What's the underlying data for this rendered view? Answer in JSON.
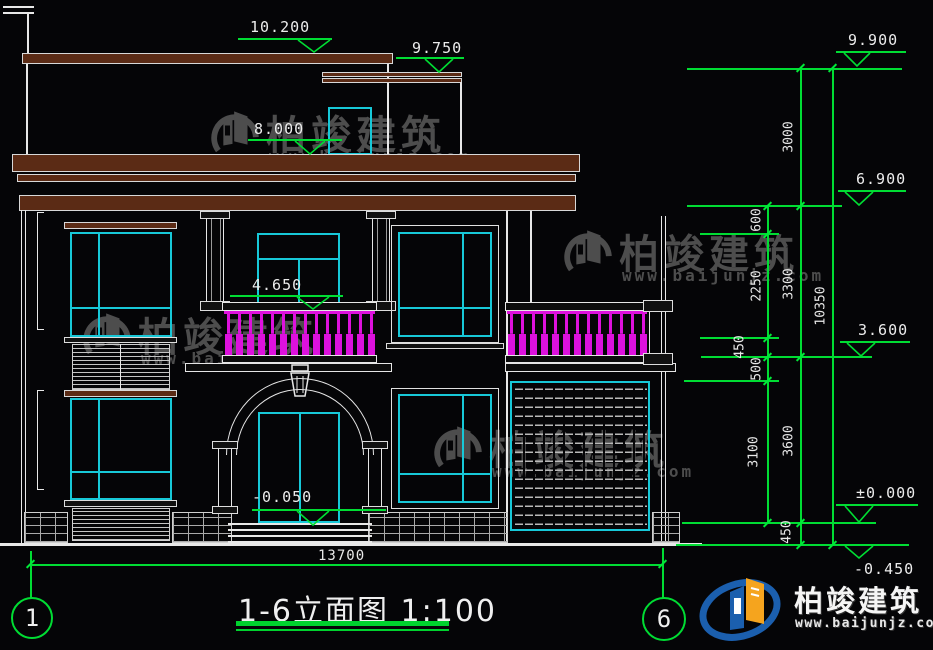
{
  "drawing": {
    "title": "1-6立面图 1:100",
    "bottom_dim": "13700",
    "axis_bubble_left": "1",
    "axis_bubble_right": "6",
    "levels_building": [
      {
        "name": "roof-top",
        "value": "10.200"
      },
      {
        "name": "roof-low",
        "value": "9.750"
      },
      {
        "name": "main-roof",
        "value": "8.000"
      },
      {
        "name": "balcony",
        "value": "4.650"
      },
      {
        "name": "entry-floor",
        "value": "-0.050"
      }
    ],
    "levels_right": [
      {
        "name": "parapet",
        "value": "9.900"
      },
      {
        "name": "second-floor",
        "value": "6.900"
      },
      {
        "name": "mid",
        "value": "3.600"
      },
      {
        "name": "zero",
        "value": "±0.000"
      },
      {
        "name": "grade",
        "value": "-0.450"
      }
    ],
    "dim_chain_inner": [
      "600",
      "2250",
      "450",
      "500",
      "3100"
    ],
    "dim_chain_mid": [
      "3000",
      "3300",
      "3600",
      "450"
    ],
    "dim_total": "10350"
  },
  "watermark": {
    "brand": "柏竣建筑",
    "site": "www.baijunjz.com"
  },
  "brand": {
    "name": "柏竣建筑",
    "site": "www.baijunjz.com"
  },
  "colors": {
    "accent_green": "#00DD33",
    "cad_cyan": "#17C8D8",
    "cad_magenta": "#DD11DD",
    "roof_brown": "#5B2B15",
    "line_white": "#E8E8E8",
    "brand_blue": "#1B5FAE",
    "brand_orange": "#F5A41E",
    "watermark_gray": "#7D7D7D"
  }
}
